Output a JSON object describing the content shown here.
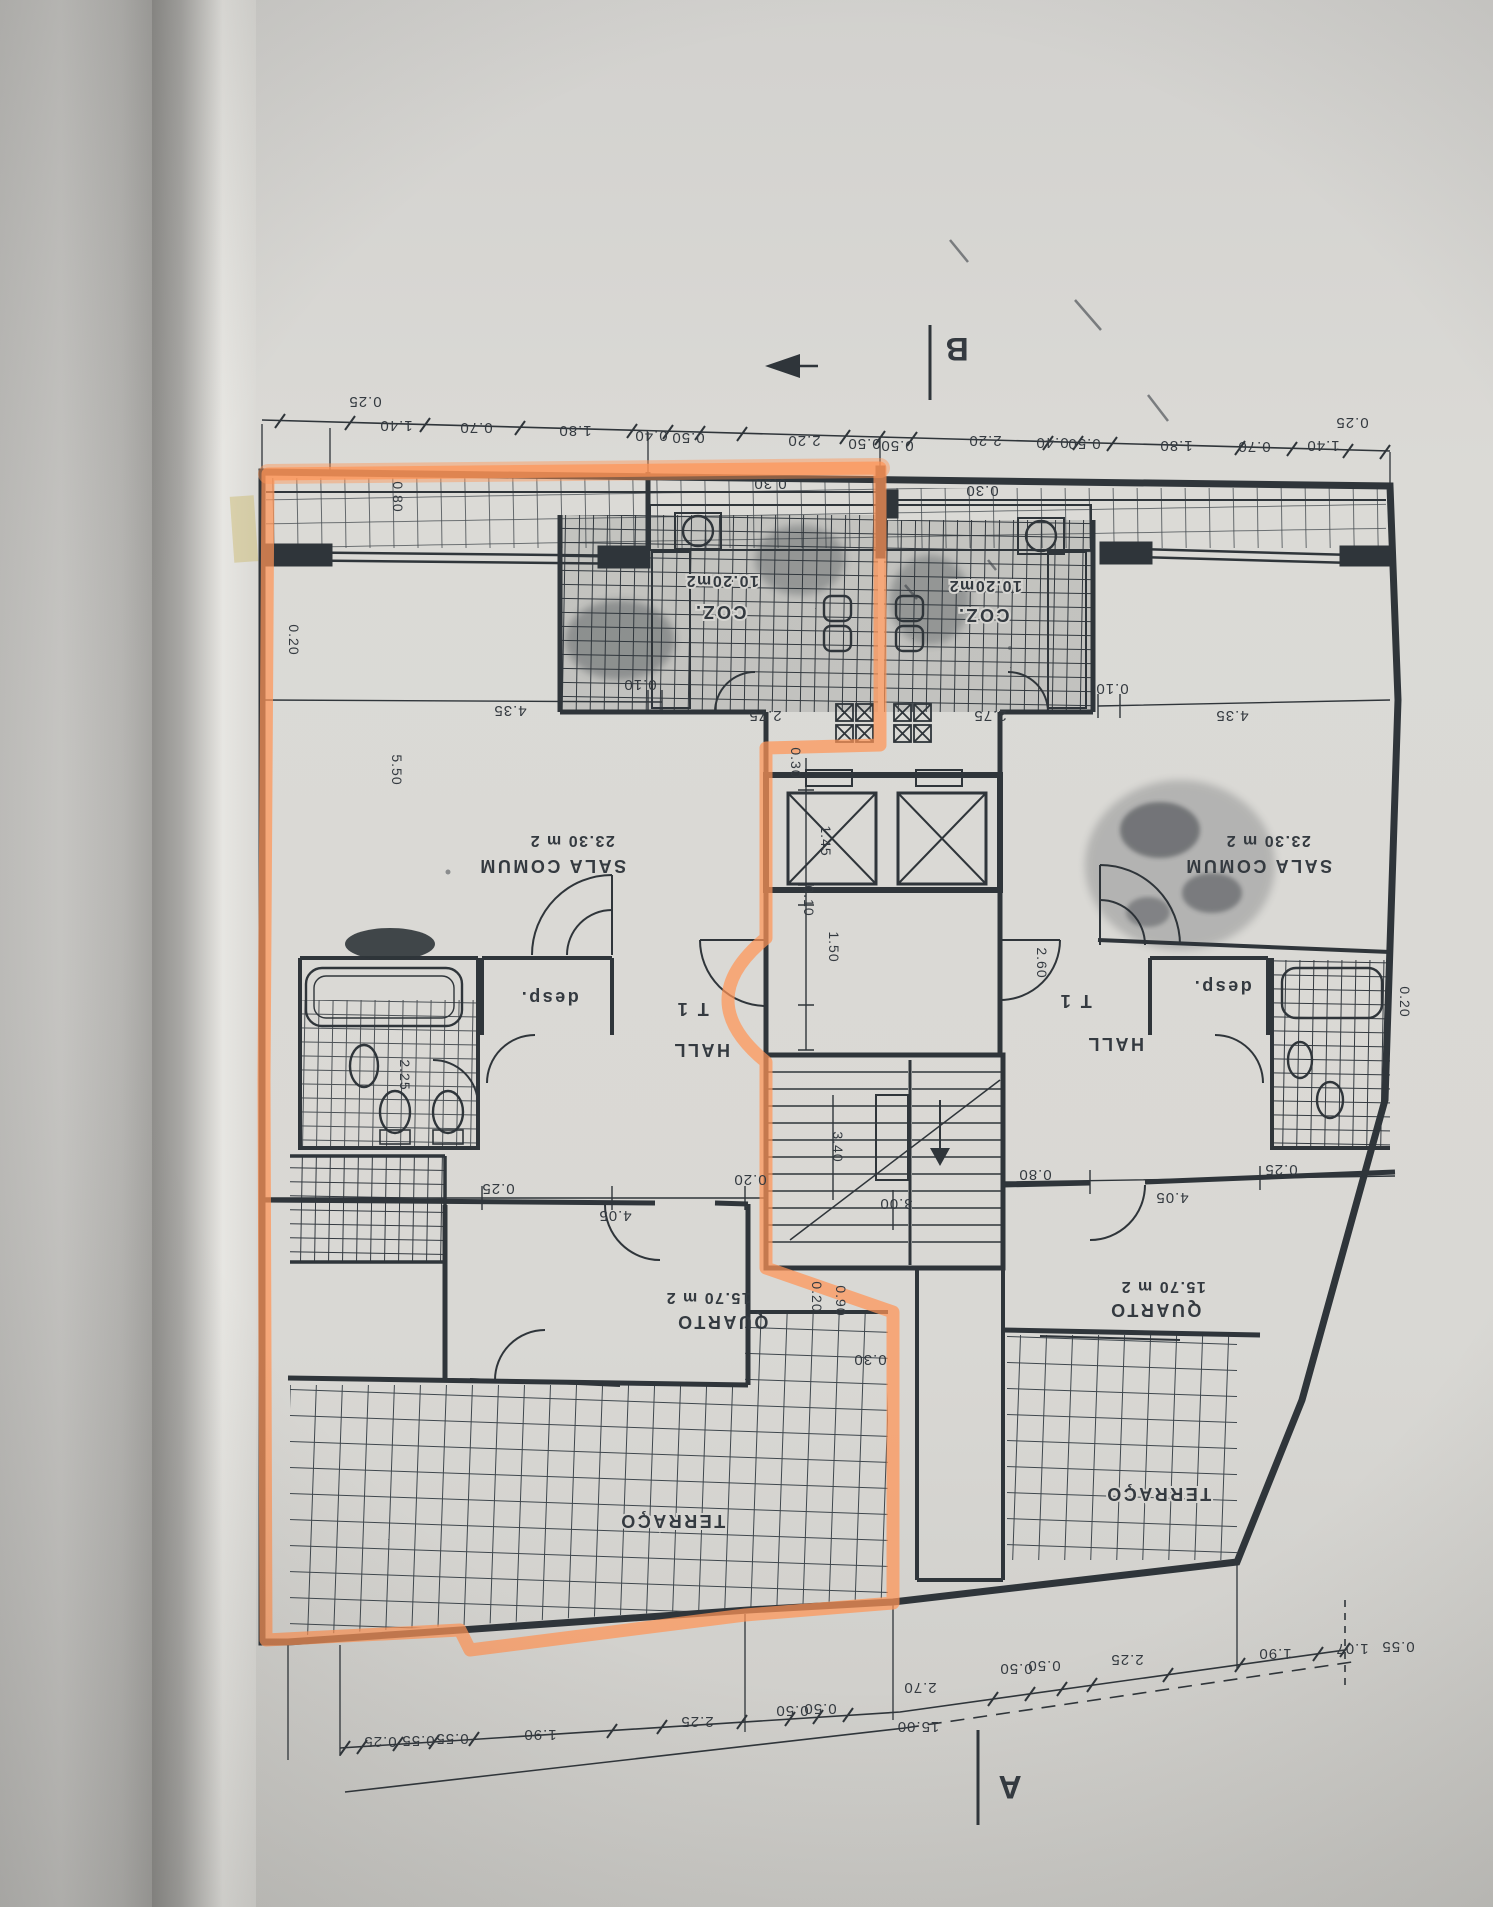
{
  "photo": {
    "description": "photograph of an architectural floor-plan page in a binder, drawing appears rotated 180 degrees",
    "paper_color": "#dbdad6",
    "ink_color": "#2f353a",
    "highlight_color": "#ff9456"
  },
  "plan": {
    "markers": {
      "a": "A",
      "b": "B"
    },
    "unit_type": "T 1",
    "rooms": {
      "sala": "SALA COMUM",
      "sala_area": "23.30 m 2",
      "quarto": "QUARTO",
      "quarto_area": "15.70 m 2",
      "hall": "HALL",
      "desp": "desp.",
      "terraco": "TERRAÇO",
      "coz": "COZ.",
      "coz_area": "10.20m2"
    },
    "dims": {
      "d010": "0.10",
      "d020": "0.20",
      "d025": "0.25",
      "d030": "0.30",
      "d040": "0.40",
      "d050": "0.50",
      "d055": "0.55",
      "d070": "0.70",
      "d080": "0.80",
      "d090": "0.90",
      "d107": "1.07",
      "d140": "1.40",
      "d145": "1.45",
      "d150": "1.50",
      "d180": "1.80",
      "d190": "1.90",
      "d220": "2.20",
      "d225": "2.25",
      "d260": "2.60",
      "d270": "2.70",
      "d275": "2.75",
      "d300": "3.00",
      "d340": "3.40",
      "d405": "4.05",
      "d435": "4.35",
      "d550": "5.50",
      "d1500": "15.00"
    }
  }
}
